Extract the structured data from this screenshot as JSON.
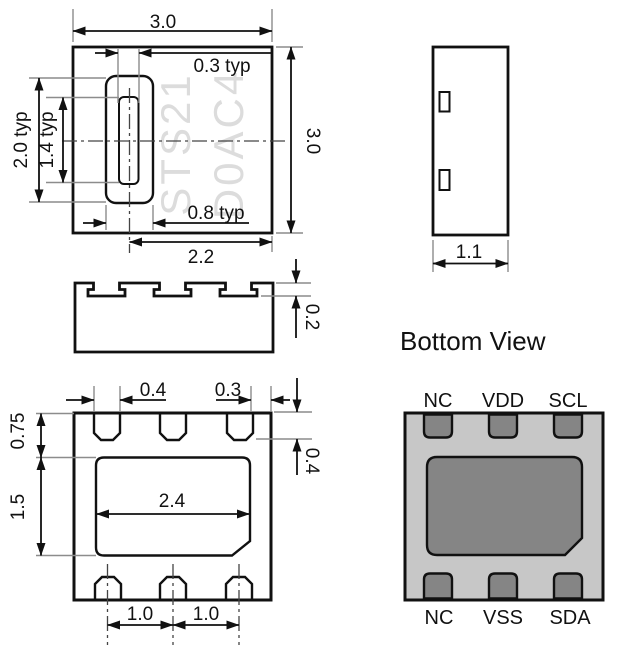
{
  "colors": {
    "line": "#111111",
    "body_gray": "#c7c7c7",
    "pad_gray": "#858585",
    "watermark": "#dcdcdc"
  },
  "top_view": {
    "marking": {
      "line1": "STS21",
      "line2": "D0AC4"
    },
    "dims": {
      "body_width": "3.0",
      "body_height": "3.0",
      "slit_width": "0.3 typ",
      "opening_width": "0.8 typ",
      "opening_height": "2.0 typ",
      "slit_height": "1.4 typ",
      "center_to_edge": "2.2"
    }
  },
  "side_view": {
    "dims": {
      "pad_depth": "0.2"
    }
  },
  "end_view": {
    "dims": {
      "body_thickness": "1.1"
    }
  },
  "footprint_view": {
    "dims": {
      "pad_width": "0.4",
      "edge_gap": "0.3",
      "pad_length": "0.4",
      "edge_to_die_pad": "0.75",
      "die_pad_height": "1.5",
      "die_pad_width": "2.4",
      "pitch_left": "1.0",
      "pitch_right": "1.0"
    }
  },
  "bottom_view": {
    "title": "Bottom View",
    "pins_top": [
      "NC",
      "VDD",
      "SCL"
    ],
    "pins_bottom": [
      "NC",
      "VSS",
      "SDA"
    ]
  }
}
